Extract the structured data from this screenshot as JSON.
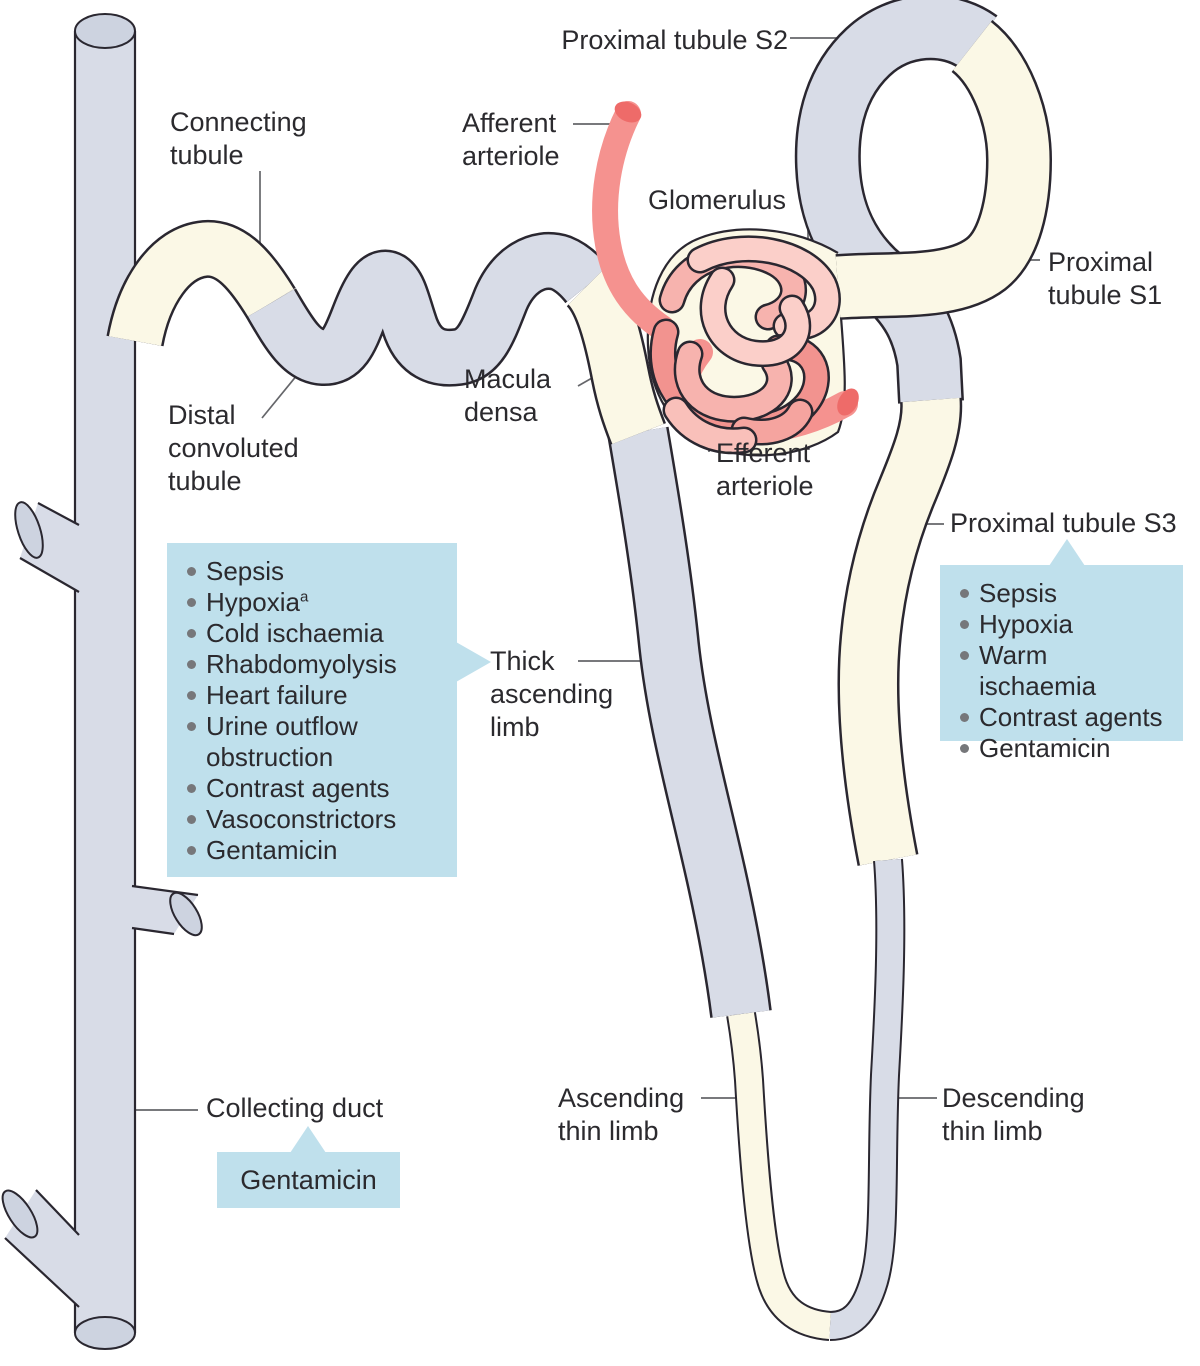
{
  "labels": {
    "proximal_tubule_s2": "Proximal tubule S2",
    "afferent_arteriole": "Afferent arteriole",
    "glomerulus": "Glomerulus",
    "proximal_tubule_s1": "Proximal tubule S1",
    "connecting_tubule": "Connecting tubule",
    "macula_densa": "Macula densa",
    "distal_convoluted_tubule": "Distal convoluted tubule",
    "efferent_arteriole": "Efferent arteriole",
    "proximal_tubule_s3": "Proximal tubule S3",
    "thick_ascending_limb": "Thick ascending limb",
    "collecting_duct": "Collecting duct",
    "ascending_thin_limb": "Ascending thin limb",
    "descending_thin_limb": "Descending thin limb"
  },
  "causes": {
    "thick_ascending_limb": {
      "items": [
        "Sepsis",
        "Hypoxia^a",
        "Cold ischaemia",
        "Rhabdomyolysis",
        "Heart failure",
        "Urine outflow obstruction",
        "Contrast agents",
        "Vasoconstrictors",
        "Gentamicin"
      ]
    },
    "proximal_tubule_s3": {
      "items": [
        "Sepsis",
        "Hypoxia",
        "Warm ischaemia",
        "Contrast agents",
        "Gentamicin"
      ]
    },
    "collecting_duct": {
      "items": [
        "Gentamicin"
      ]
    }
  },
  "colors": {
    "tubule_grey": "#d8dce7",
    "tubule_cream": "#fbf8e6",
    "cap_grey": "#cdd3e0",
    "outline": "#2a2730",
    "arteriole_pink": "#f5928f",
    "arteriole_cap": "#ee6b69",
    "box_blue": "#bfe0ec",
    "bullet_grey": "#76777a",
    "text": "#2b2a2e",
    "leader": "#65666a"
  }
}
